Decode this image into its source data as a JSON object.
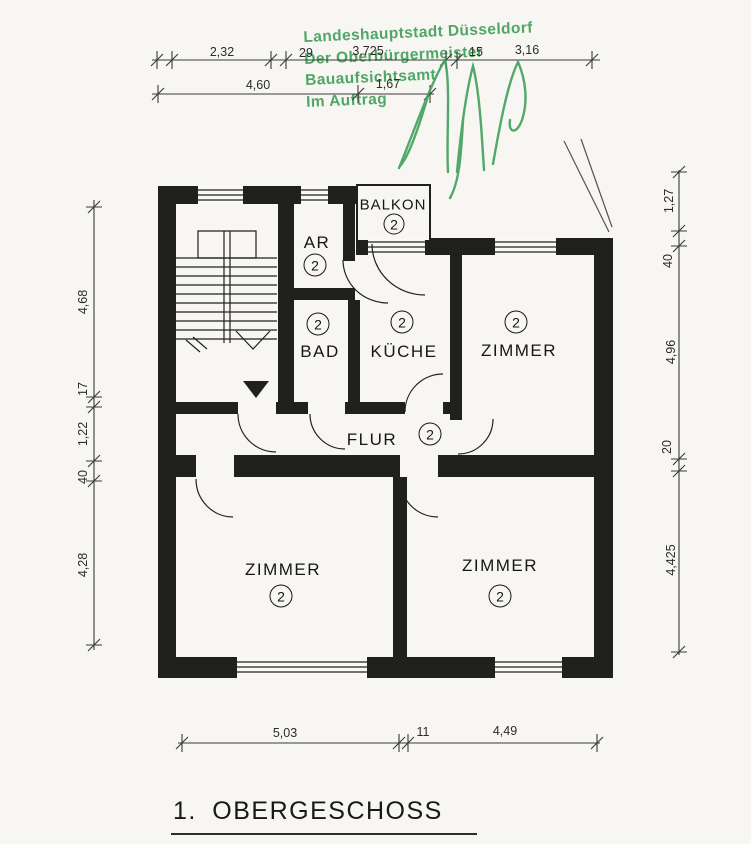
{
  "stamp": {
    "line1": "Landeshauptstadt Düsseldorf",
    "line2": "Der Oberbürgermeister",
    "line3": "Bauaufsichtsamt",
    "line4": "Im Auftrag"
  },
  "title": "1. OBERGESCHOSS",
  "rooms": {
    "balkon": {
      "label": "BALKON",
      "unit": "2"
    },
    "ar": {
      "label": "AR",
      "unit": "2"
    },
    "bad": {
      "label": "BAD",
      "unit": "2"
    },
    "kueche": {
      "label": "KÜCHE",
      "unit": "2"
    },
    "zimmer_top_right": {
      "label": "ZIMMER",
      "unit": "2"
    },
    "flur": {
      "label": "FLUR",
      "unit": "2"
    },
    "zimmer_bottom_left": {
      "label": "ZIMMER",
      "unit": "2"
    },
    "zimmer_bottom_right": {
      "label": "ZIMMER",
      "unit": "2"
    }
  },
  "dimensions": {
    "top1": [
      "2,32",
      "29",
      "3,725",
      "15",
      "3,16"
    ],
    "top2": [
      "4,60",
      "1,67"
    ],
    "left": [
      "4,68",
      "17",
      "1,22",
      "40",
      "4,28"
    ],
    "right": [
      "1,27",
      "40",
      "4,96",
      "20",
      "4,425"
    ],
    "bottom": [
      "5,03",
      "11",
      "4,49"
    ]
  },
  "colors": {
    "stamp_green": "#41a05b",
    "ink": "#20201e",
    "paper": "#f7f6f2"
  }
}
